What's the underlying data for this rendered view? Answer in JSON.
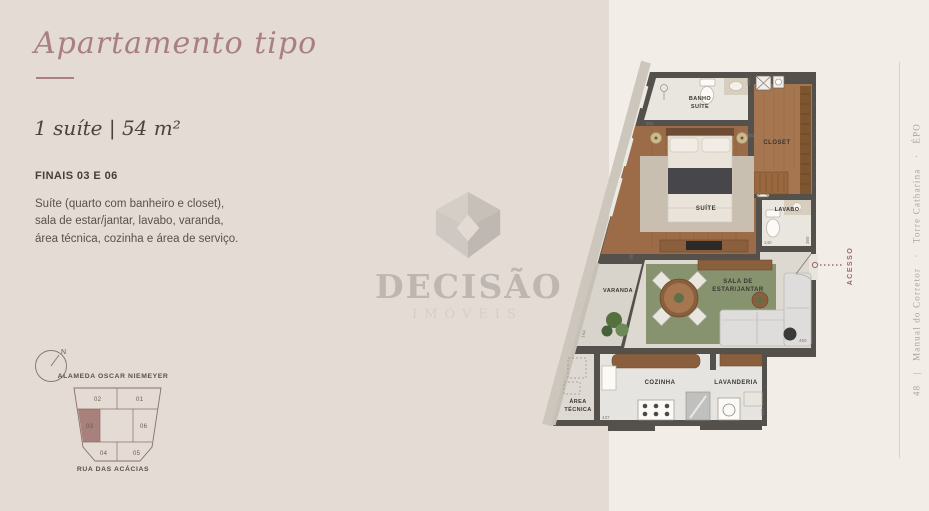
{
  "header": {
    "title": "Apartamento tipo",
    "subtitle": "1 suíte | 54 m²",
    "plan_code": "FINAIS 03 E 06",
    "description_lines": [
      "Suíte (quarto com banheiro e closet),",
      "sala de estar/jantar, lavabo, varanda,",
      "área técnica, cozinha e área de serviço."
    ]
  },
  "location": {
    "compass_north": "N",
    "street_top": "ALAMEDA OSCAR NIEMEYER",
    "street_bottom": "RUA DAS ACÁCIAS",
    "units": [
      "02",
      "01",
      "03",
      "06",
      "04",
      "05"
    ],
    "highlighted_unit": "03"
  },
  "watermark": {
    "brand": "DECISÃO",
    "subtitle": "IMÓVEIS"
  },
  "floorplan": {
    "labels": {
      "banho_line1": "BANHO",
      "banho_line2": "SUÍTE",
      "closet": "CLOSET",
      "suite": "SUÍTE",
      "lavabo": "LAVABO",
      "sala_line1": "SALA DE",
      "sala_line2": "ESTAR/JANTAR",
      "varanda": "VARANDA",
      "cozinha": "COZINHA",
      "lavanderia": "LAVANDERIA",
      "area_line1": "ÁREA",
      "area_line2": "TÉCNICA"
    },
    "access_label": "ACESSO",
    "dimensions": [
      "282",
      "303",
      "130",
      "140",
      "360",
      "205",
      "144",
      "437",
      "450",
      "150"
    ]
  },
  "sidebar": {
    "caption": "48   |   Manual do Corretor   ·   Torre Catharina   ·   ÉPO"
  },
  "colors": {
    "accent": "#a97f84",
    "highlighted_unit_fill": "#a8807c",
    "access": "#9a6a6e",
    "wall": "#54514c"
  }
}
